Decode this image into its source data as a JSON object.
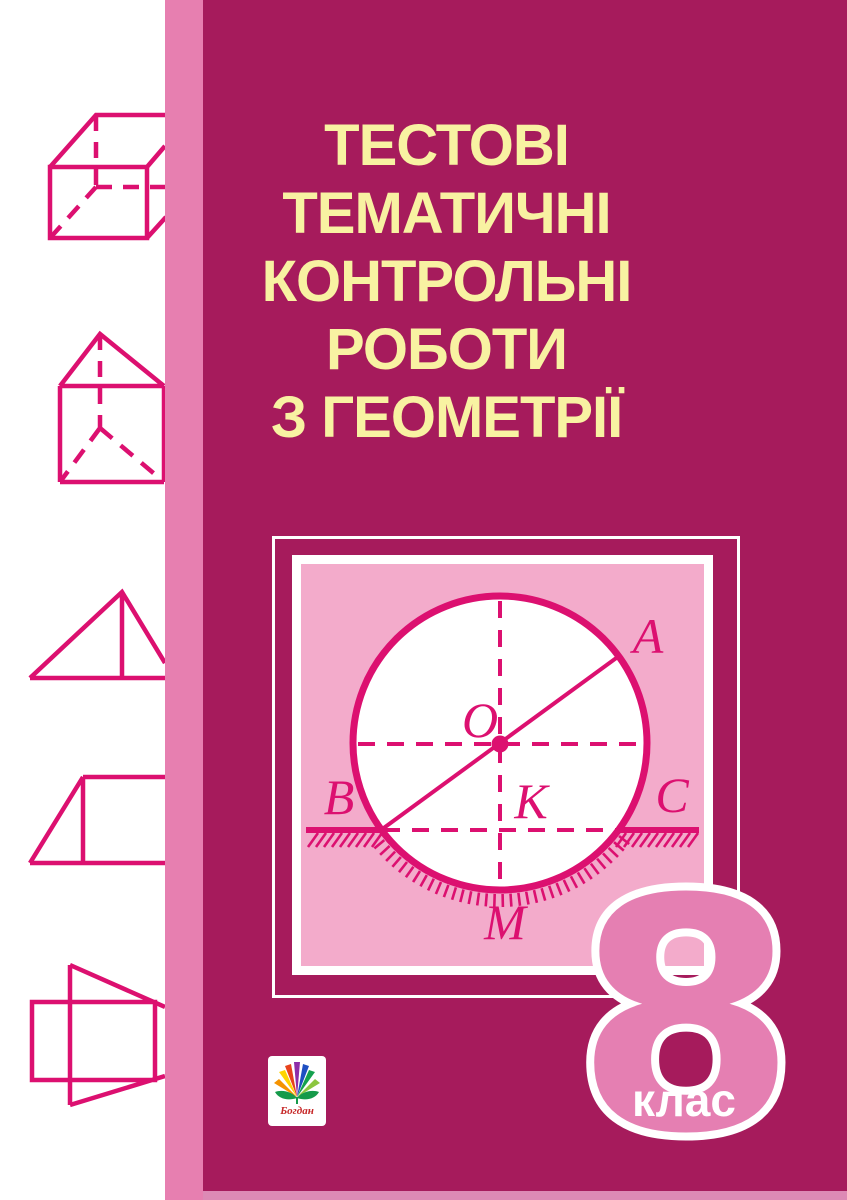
{
  "title_lines": [
    "ТЕСТОВІ",
    "ТЕМАТИЧНІ",
    "КОНТРОЛЬНІ",
    "РОБОТИ",
    "З ГЕОМЕТРІЇ"
  ],
  "grade": {
    "number": "8",
    "label": "клас"
  },
  "publisher": {
    "name": "Богдан"
  },
  "diagram": {
    "labels": {
      "O": "O",
      "A": "A",
      "B": "B",
      "K": "K",
      "C": "C",
      "M": "M"
    }
  },
  "colors": {
    "background_magenta": "#A61B5C",
    "spine_pink": "#E77FB0",
    "panel_pink": "#F3ABCB",
    "line_magenta": "#DC1070",
    "title_yellow": "#F8F2A2",
    "grade_pink": "#E57FB2",
    "white": "#FFFFFF"
  }
}
